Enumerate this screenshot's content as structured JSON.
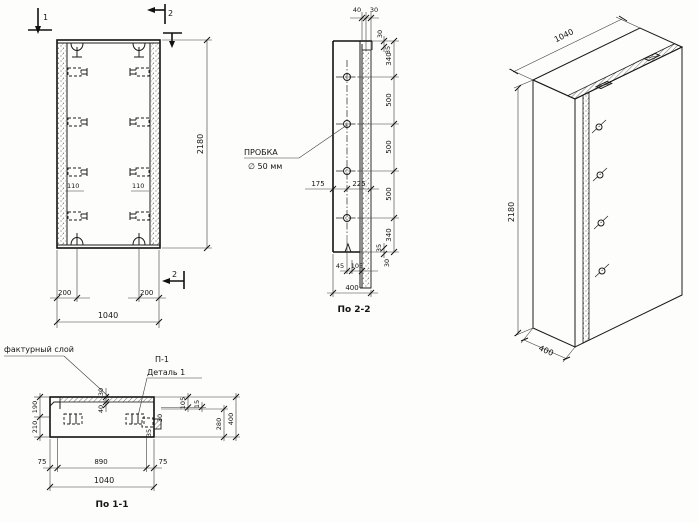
{
  "front_view": {
    "cut_label_1": "1",
    "cut_label_2_top": "2",
    "cut_label_2_bottom": "2",
    "dim_height": "2180",
    "dim_offset_left": "200",
    "dim_offset_right": "200",
    "dim_width_total": "1040",
    "dim_bracket_left": "110",
    "dim_bracket_right": "110"
  },
  "section_2_2": {
    "caption": "По 2-2",
    "plug_label_line1": "ПРОБКА",
    "plug_label_line2": "∅ 50 мм",
    "dim_top_40": "40",
    "dim_top_30": "30",
    "dim_tr_30": "30",
    "dim_tr_35": "35",
    "dim_chain": [
      "340",
      "500",
      "500",
      "500",
      "340"
    ],
    "dim_br_35": "35",
    "dim_br_30": "30",
    "dim_mid_175": "175",
    "dim_mid_225": "225",
    "dim_bot_45": "45",
    "dim_bot_105": "105",
    "dim_total_400": "400"
  },
  "iso_view": {
    "dim_width": "1040",
    "dim_height": "2180",
    "dim_depth": "400"
  },
  "section_1_1": {
    "caption": "По 1-1",
    "label_facing": "фактурный слой",
    "label_detail_1": "П-1",
    "label_detail_2": "Деталь 1",
    "dim_left_190": "190",
    "dim_left_210": "210",
    "dim_mid_30": "30",
    "dim_mid_40": "40",
    "dim_det_30": "30",
    "dim_det_35": "35",
    "dim_r_105": "105",
    "dim_r_15": "15",
    "dim_r_280": "280",
    "dim_r_400": "400",
    "dim_b_75l": "75",
    "dim_b_890": "890",
    "dim_b_75r": "75",
    "dim_b_1040": "1040"
  }
}
